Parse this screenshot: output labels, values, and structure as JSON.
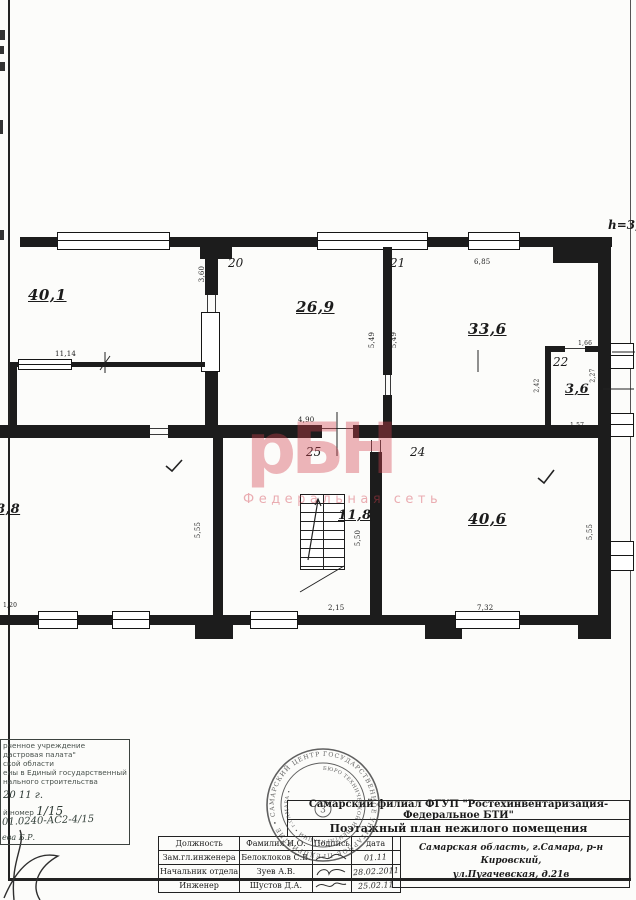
{
  "watermark": {
    "big": "рБН",
    "small": "Федеральная сеть",
    "color": "#d13e4d"
  },
  "plan": {
    "height_note": "h=3,",
    "labels": {
      "a40_1": "40,1",
      "a26_9": "26,9",
      "a33_6": "33,6",
      "a3_6": "3,6",
      "a11_8": "11,8",
      "a40_6": "40,6",
      "a8_8": "8,8",
      "n20": "20",
      "n21": "21",
      "n22": "22",
      "n24": "24",
      "n25": "25"
    },
    "dims": {
      "d1114": "11,14",
      "d360": "3,60",
      "d490": "4,90",
      "d549a": "5,49",
      "d549b": "5,49",
      "d685": "6,85",
      "d166": "1,66",
      "d227": "2,27",
      "d242": "2,42",
      "d157": "1,57",
      "d555a": "5,55",
      "d550": "5,50",
      "d215": "2,15",
      "d732": "7,32",
      "d555b": "5,55",
      "d120": "1,20"
    }
  },
  "corner_stamp": {
    "line1": "рченное учреждение",
    "line2": "дастровая палата\"",
    "line3": "ской области",
    "line4": "ены в Единый государственный",
    "line5": "нального строительства",
    "date_line": "20 11 г.",
    "number_label": "й номер",
    "number_value": "1/15",
    "case_number": "01.0240-АС2-4/15",
    "signed_name": "ева  Б.Р."
  },
  "seal": {
    "ring_text": "ГОСУДАРСТВЕННОЕ УНИТАРНОЕ ПРЕДПРИЯТИЕ • САМАРСКИЙ ЦЕНТР ИНВЕНТАРИЗАЦИИ •",
    "inner_ring_text": "БЮРО ТЕХНИЧЕСКОЙ ИНВЕНТАРИЗАЦИИ • г.САМАРА •",
    "center": "3"
  },
  "title_block": {
    "org": "Самарский филиал ФГУП \"Ростехинвентаризация-Федеральное БТИ\"",
    "doc_title": "Поэтажный план нежилого помещения",
    "address_line1": "Самарская область, г.Самара, р-н Кировский,",
    "address_line2": "ул.Пугачевская, д.21в",
    "table": {
      "headers": [
        "Должность",
        "Фамилия И.О.",
        "Подпись",
        "дата"
      ],
      "rows": [
        {
          "position": "Зам.гл.инженера",
          "name": "Белоклоков С.В.",
          "date": "01.11"
        },
        {
          "position": "Начальник отдела",
          "name": "Зуев А.В.",
          "date": "28.02.2011"
        },
        {
          "position": "Инженер",
          "name": "Шустов Д.А.",
          "date": "25.02.11"
        }
      ]
    }
  }
}
